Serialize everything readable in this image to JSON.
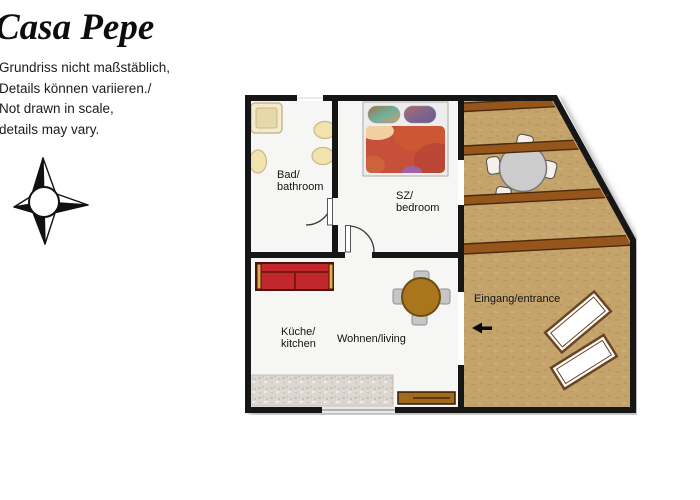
{
  "header": {
    "title": "Casa Pepe",
    "disclaimer": "Grundriss nicht maßstäblich,\nDetails können variieren./\nNot drawn in scale,\ndetails may vary."
  },
  "floorplan": {
    "rooms": {
      "bathroom": {
        "label": "Bad/\nbathroom"
      },
      "bedroom": {
        "label": "SZ/\nbedroom"
      },
      "kitchen": {
        "label": "Küche/\nkitchen"
      },
      "living": {
        "label": "Wohnen/living"
      },
      "entrance": {
        "label": "Eingang/entrance"
      }
    },
    "icons": {
      "compass": "compass-rose",
      "entrance_arrow": "left-arrow"
    },
    "colors": {
      "wall": "#161616",
      "floor": "#f6f6f4",
      "terrace": "#c5a46c",
      "beam": "#96551b",
      "beam_edge": "#4a2a0c",
      "sofa": "#c1272d",
      "sofa_dark": "#7d1712",
      "sofa_trim": "#d8b04a",
      "duvet": "#c6503a",
      "bed_frame": "#ededed",
      "wood": "#a9761d",
      "wood_edge": "#6f4c0f",
      "fixture": "#f0e3ae",
      "fixture_edge": "#c9b98a",
      "counter": "#dcd7d1",
      "chair_gray": "#c6c6c6",
      "table_gray": "#cccccc",
      "chair_white": "#f4f1ea",
      "lounger_edge": "#6b4423",
      "sideboard": "#a36a1e"
    }
  }
}
